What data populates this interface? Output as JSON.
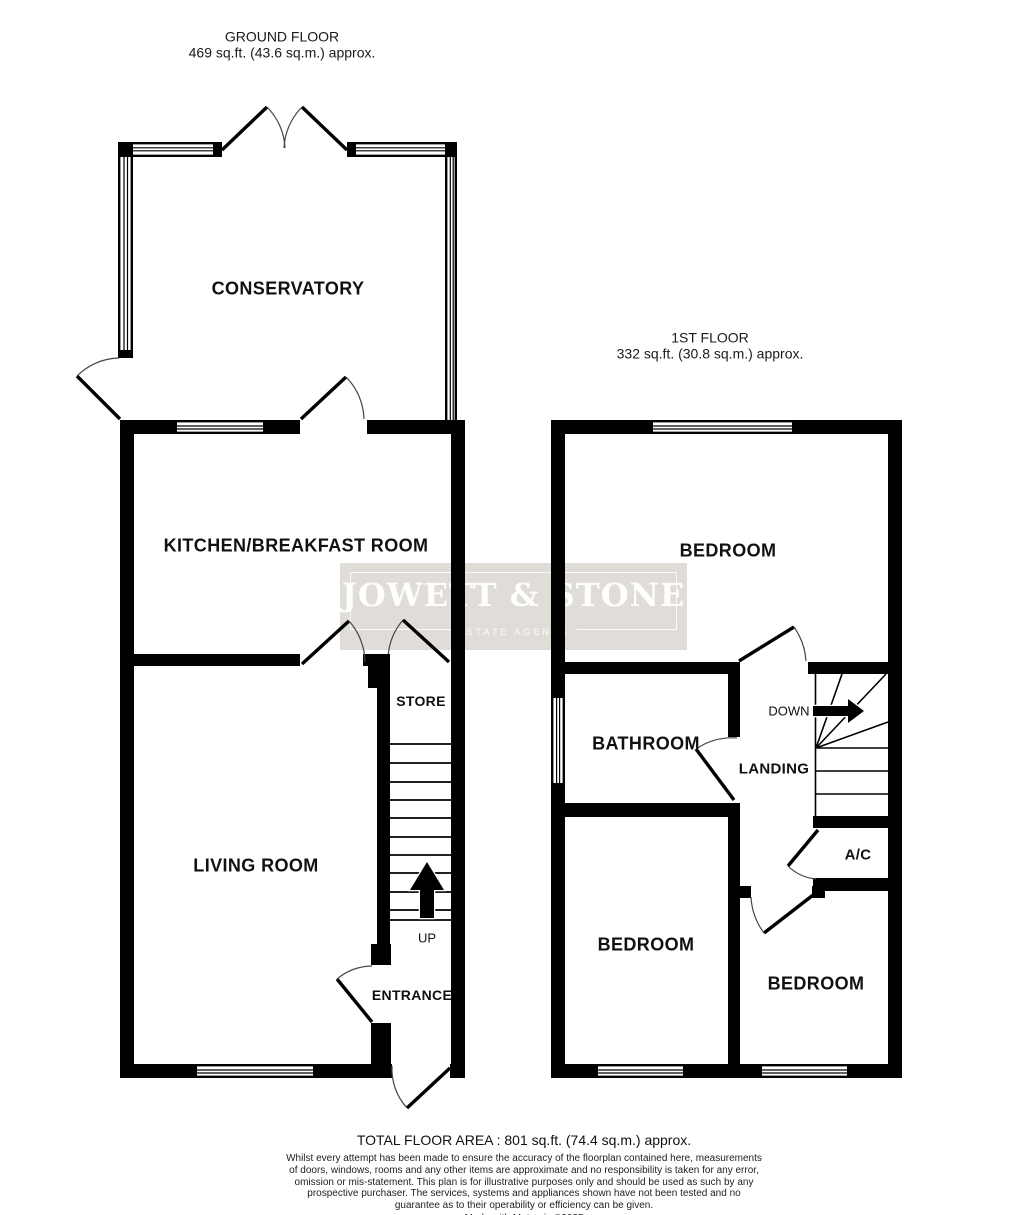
{
  "colors": {
    "wall": "#000000",
    "background": "#ffffff",
    "watermark_bg": "#e0ddd8",
    "watermark_text": "#ffffff",
    "label_text": "#111111"
  },
  "ground_floor": {
    "title": "GROUND FLOOR",
    "area": "469 sq.ft. (43.6 sq.m.) approx.",
    "labels": {
      "conservatory": "CONSERVATORY",
      "kitchen": "KITCHEN/BREAKFAST ROOM",
      "living_room": "LIVING ROOM",
      "store": "STORE",
      "up": "UP",
      "entrance": "ENTRANCE"
    }
  },
  "first_floor": {
    "title": "1ST FLOOR",
    "area": "332 sq.ft. (30.8 sq.m.) approx.",
    "labels": {
      "bedroom_top": "BEDROOM",
      "bathroom": "BATHROOM",
      "landing": "LANDING",
      "down": "DOWN",
      "ac": "A/C",
      "bedroom_left": "BEDROOM",
      "bedroom_right": "BEDROOM"
    }
  },
  "watermark": {
    "name": "JOWETT & STONE",
    "tagline": "ESTATE AGENTS"
  },
  "footer": {
    "total_area": "TOTAL FLOOR AREA : 801 sq.ft. (74.4 sq.m.) approx.",
    "disclaimer": "Whilst every attempt has been made to ensure the accuracy of the floorplan contained here, measurements of doors, windows, rooms and any other items are approximate and no responsibility is taken for any error, omission or mis-statement. This plan is for illustrative purposes only and should be used as such by any prospective purchaser. The services, systems and appliances shown have not been tested and no guarantee as to their operability or efficiency can be given.",
    "credit": "Made with Metropix ©2025"
  }
}
